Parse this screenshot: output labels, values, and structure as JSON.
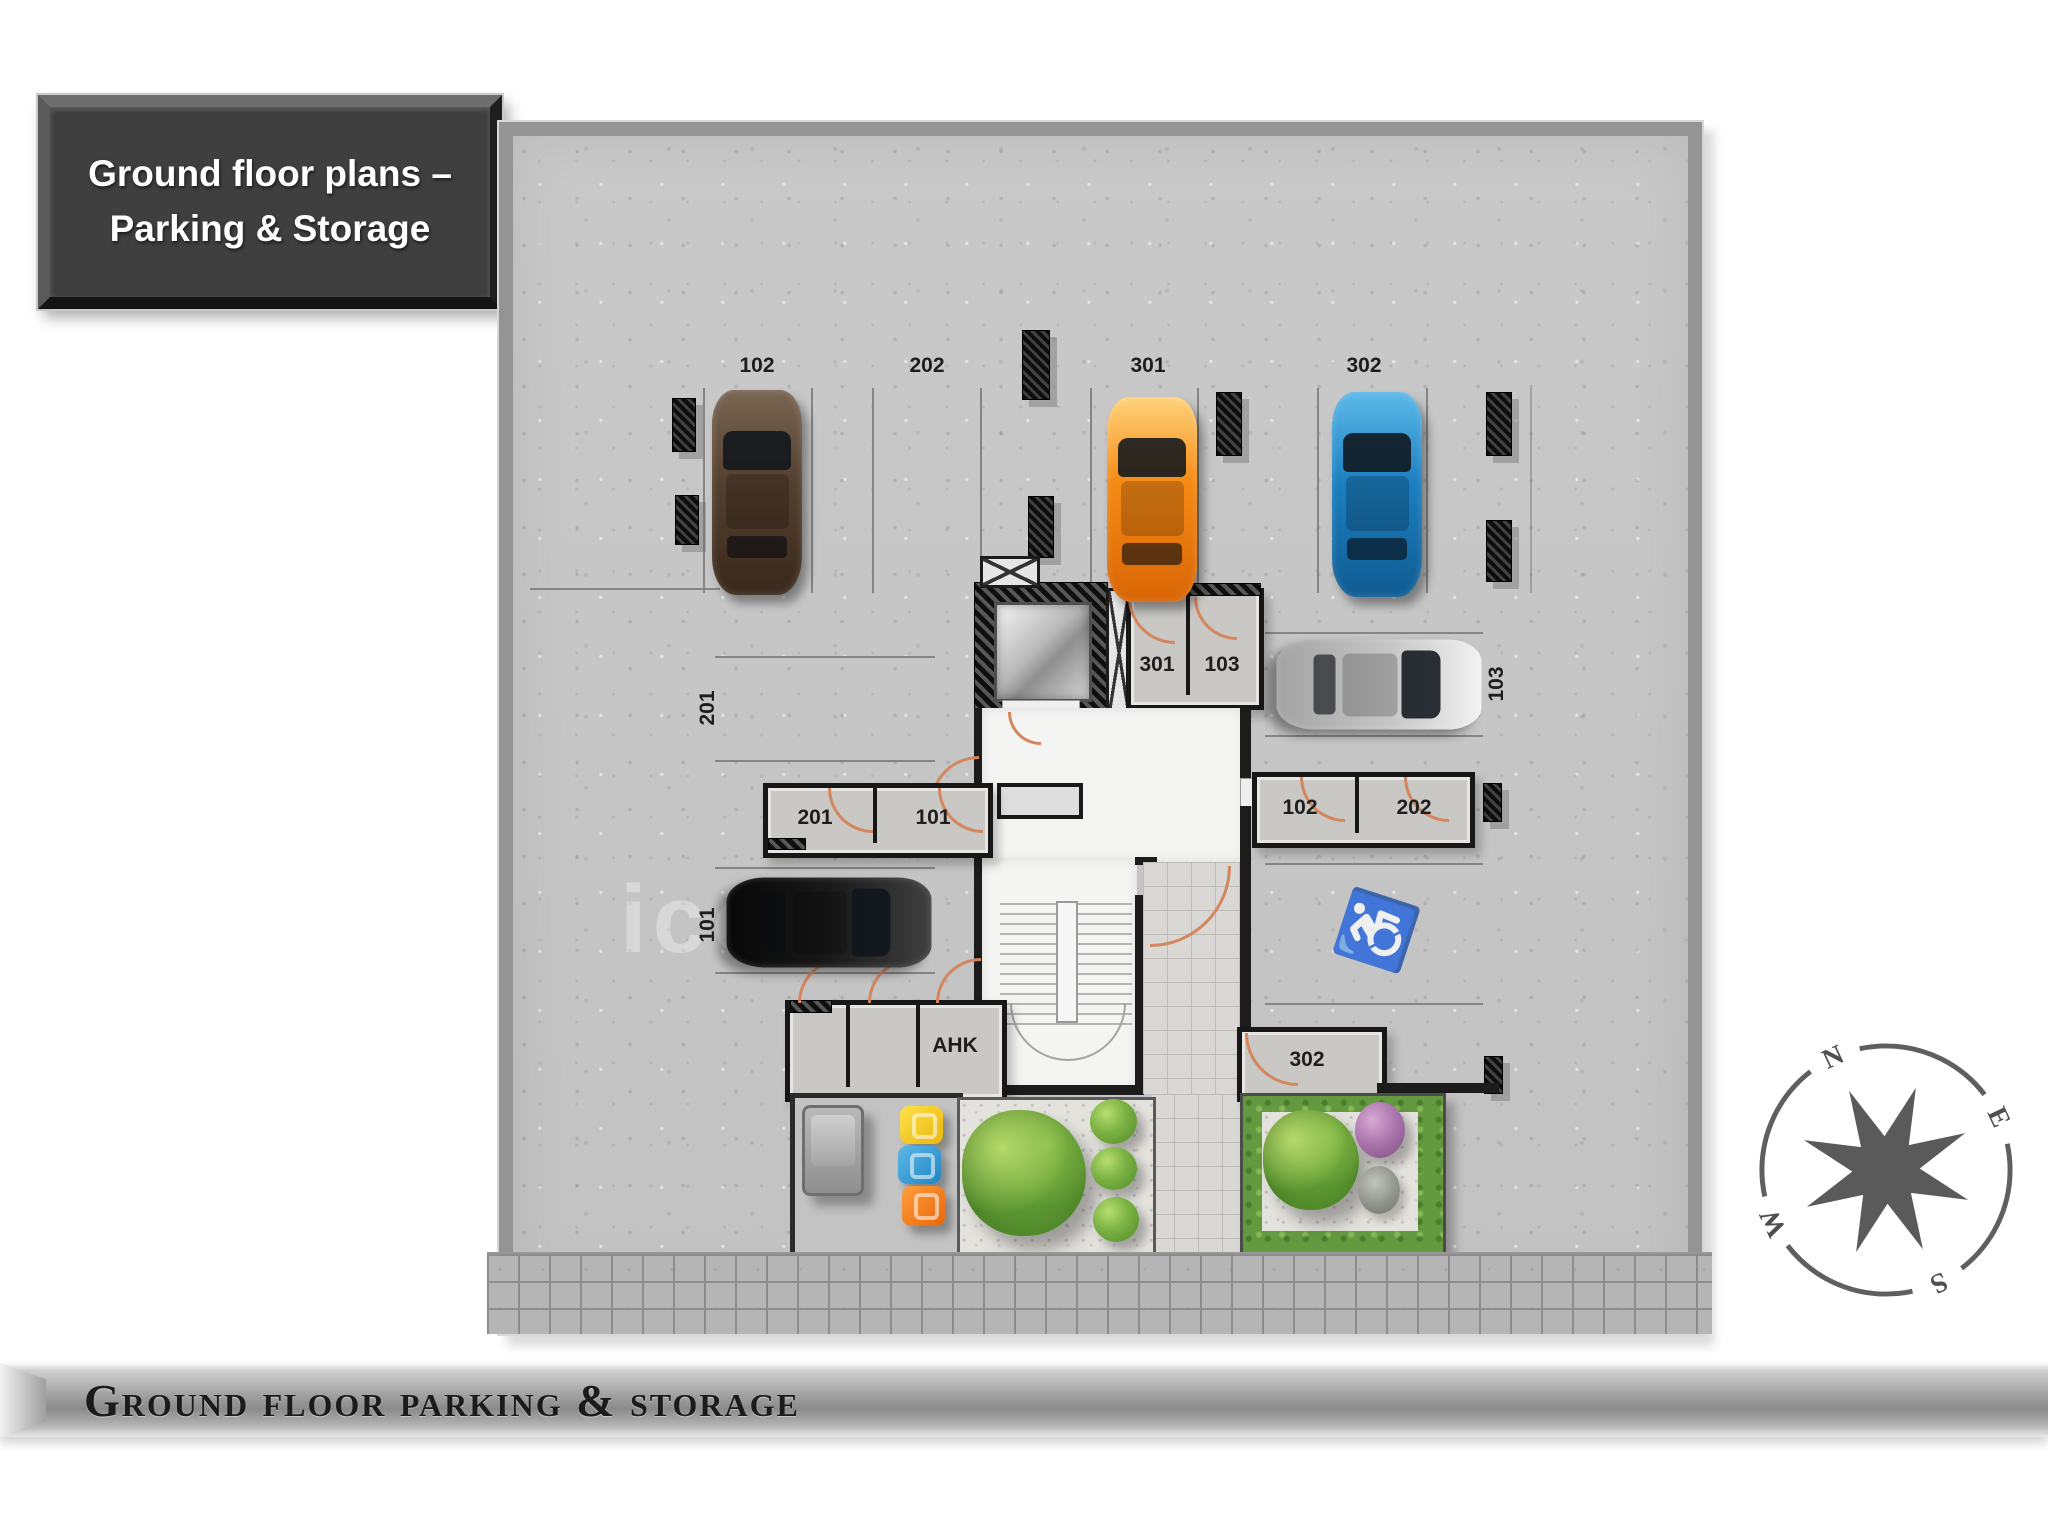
{
  "slide": {
    "title_line1": "Ground floor plans –",
    "title_line2": "Parking & Storage",
    "footer_caption": "Ground floor parking & storage",
    "watermark": "icon"
  },
  "compass": {
    "north": "N",
    "east": "E",
    "south": "S",
    "west": "W"
  },
  "floor_plan": {
    "parking_spaces": [
      {
        "id": "102",
        "label": "102",
        "orientation": "vertical",
        "occupied_by": "brown-car"
      },
      {
        "id": "202",
        "label": "202",
        "orientation": "vertical",
        "occupied_by": null
      },
      {
        "id": "301",
        "label": "301",
        "orientation": "vertical",
        "occupied_by": "orange-car"
      },
      {
        "id": "302",
        "label": "302",
        "orientation": "vertical",
        "occupied_by": "blue-car"
      },
      {
        "id": "201",
        "label": "201",
        "orientation": "horizontal",
        "occupied_by": null
      },
      {
        "id": "101",
        "label": "101",
        "orientation": "horizontal",
        "occupied_by": "black-car"
      },
      {
        "id": "103",
        "label": "103",
        "orientation": "horizontal",
        "occupied_by": "silver-car"
      }
    ],
    "storage_rooms": [
      {
        "label": "301"
      },
      {
        "label": "103"
      },
      {
        "label": "102"
      },
      {
        "label": "202"
      },
      {
        "label": "201"
      },
      {
        "label": "101"
      },
      {
        "label": "302"
      },
      {
        "label": "AHK"
      }
    ],
    "cars": [
      {
        "name": "brown-car",
        "space": "102",
        "color": "#54402f"
      },
      {
        "name": "orange-car",
        "space": "301",
        "color": "#f58a14"
      },
      {
        "name": "blue-car",
        "space": "302",
        "color": "#1b7ec0"
      },
      {
        "name": "silver-car",
        "space": "103",
        "color": "#c6c6c6"
      },
      {
        "name": "black-car",
        "space": "101",
        "color": "#191919"
      }
    ],
    "features": {
      "accessible_parking_icon": "♿",
      "elevator": "elevator",
      "stairs": "stairs"
    },
    "colors": {
      "concrete": "#c6c6c6",
      "boundary_wall": "#949494",
      "interior_wall": "#1c1c1c",
      "door_arc": "#d4865f",
      "grass": "#63993f",
      "walkway_tile": "#b5b5b5",
      "lobby_white": "#f4f4f3"
    }
  }
}
